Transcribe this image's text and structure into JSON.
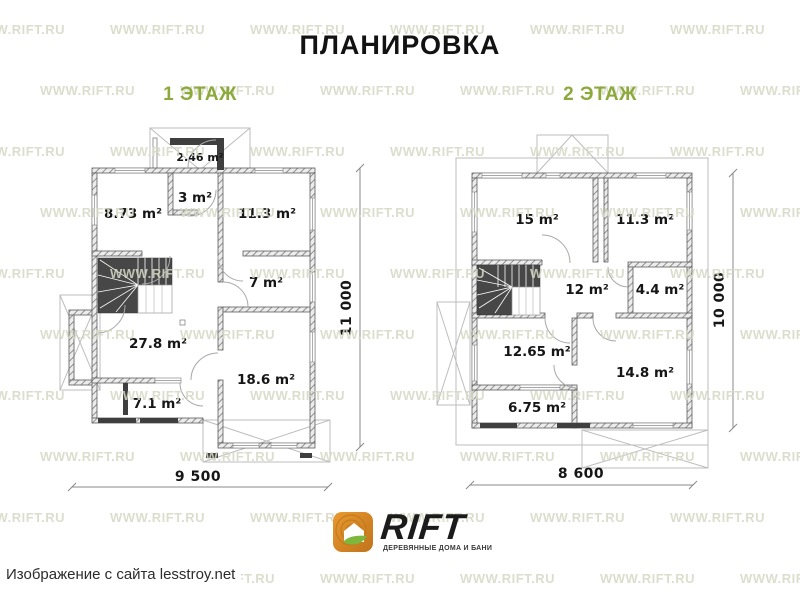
{
  "title": "ПЛАНИРОВКА",
  "caption": "Изображение с сайта lesstroy.net",
  "watermark": {
    "text": "WWW.RIFT.RU"
  },
  "logo": {
    "name": "RIFT",
    "tagline": "ДЕРЕВЯННЫЕ ДОМА И БАНИ"
  },
  "colors": {
    "accent_green": "#8CA93C",
    "logo_orange": "#E89A2F",
    "logo_orange_dark": "#C1731B",
    "leaf_green": "#7FB63C",
    "watermark": "#D5D9C5"
  },
  "floor1": {
    "heading": "1 ЭТАЖ",
    "dim_width": "9 500",
    "dim_height": "11 000",
    "rooms": [
      {
        "label": "2.46 m²"
      },
      {
        "label": "3 m²"
      },
      {
        "label": "8.73 m²"
      },
      {
        "label": "11.3 m²"
      },
      {
        "label": "7 m²"
      },
      {
        "label": "27.8 m²"
      },
      {
        "label": "18.6 m²"
      },
      {
        "label": "7.1 m²"
      }
    ]
  },
  "floor2": {
    "heading": "2 ЭТАЖ",
    "dim_width": "8 600",
    "dim_height": "10 000",
    "rooms": [
      {
        "label": "15 m²"
      },
      {
        "label": "11.3 m²"
      },
      {
        "label": "12 m²"
      },
      {
        "label": "4.4 m²"
      },
      {
        "label": "12.65 m²"
      },
      {
        "label": "14.8 m²"
      },
      {
        "label": "6.75 m²"
      }
    ]
  }
}
